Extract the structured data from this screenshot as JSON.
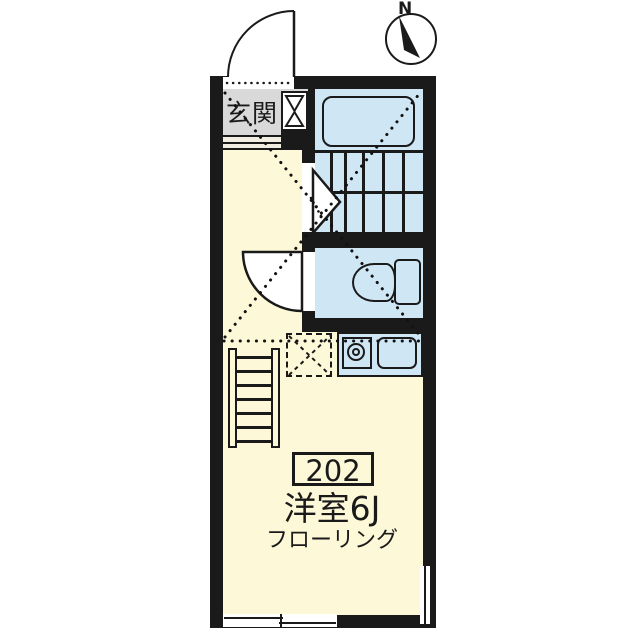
{
  "compass": {
    "label": "N"
  },
  "entrance": {
    "label": "玄関"
  },
  "unit": {
    "number": "202",
    "room_label": "洋室6J",
    "floor_label": "フローリング"
  },
  "colors": {
    "wall": "#1a1a1a",
    "room_fill": "#fdf8d8",
    "wet_area_fill": "#cfe6f4",
    "entrance_fill": "#d9d9d9",
    "background": "#ffffff"
  },
  "icons": {
    "compass": "compass-north-icon",
    "bathtub": "bathtub-icon",
    "staircase": "staircase-icon",
    "toilet": "toilet-icon",
    "stove": "stove-burner-icon",
    "sink": "kitchen-sink-icon",
    "refrigerator_space": "refrigerator-space-icon",
    "loft_ladder": "loft-ladder-icon",
    "shoe_cabinet": "shoe-cabinet-icon",
    "entrance_door": "door-swing-icon",
    "toilet_door": "door-swing-icon",
    "stair_arrow": "stair-direction-arrow-icon",
    "windows": "window-icon"
  }
}
